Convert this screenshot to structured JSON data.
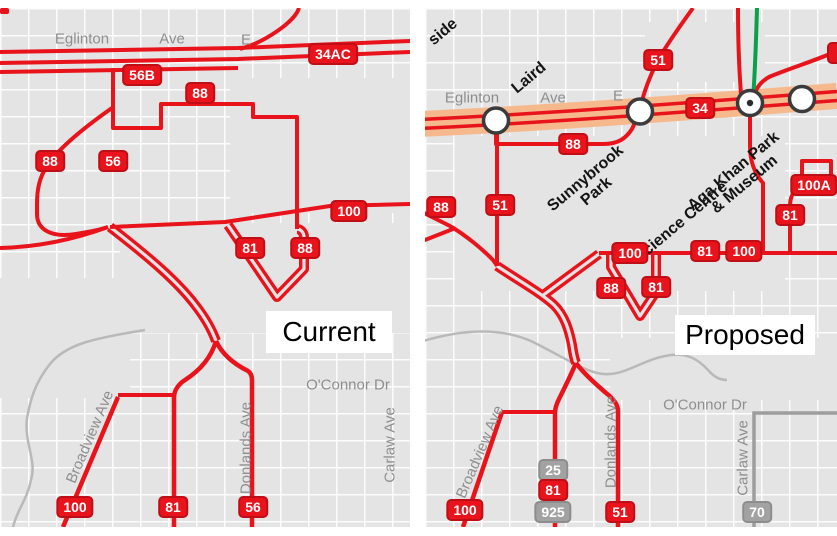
{
  "colors": {
    "route_red": "#e8131b",
    "lrt_orange": "#f6b98e",
    "subway_green": "#0aa04c",
    "other_route_gray": "#9d9d9d",
    "badge_gray": "#a2a2a2",
    "map_background": "#e4e4e4"
  },
  "panels": [
    {
      "id": "current",
      "title": "Current",
      "badges": [
        {
          "t": "34AC",
          "x": 333,
          "y": 46
        },
        {
          "t": "56B",
          "x": 142,
          "y": 67
        },
        {
          "t": "88",
          "x": 200,
          "y": 85
        },
        {
          "t": "88",
          "x": 50,
          "y": 153
        },
        {
          "t": "56",
          "x": 113,
          "y": 153
        },
        {
          "t": "100",
          "x": 349,
          "y": 203
        },
        {
          "t": "81",
          "x": 250,
          "y": 240
        },
        {
          "t": "88",
          "x": 305,
          "y": 240
        },
        {
          "t": "100",
          "x": 75,
          "y": 499
        },
        {
          "t": "81",
          "x": 173,
          "y": 499
        },
        {
          "t": "56",
          "x": 253,
          "y": 499
        }
      ],
      "street_labels": [
        {
          "t": "Eglinton",
          "x": 82,
          "y": 31,
          "rot": 0
        },
        {
          "t": "Ave",
          "x": 172,
          "y": 31,
          "rot": 0
        },
        {
          "t": "E",
          "x": 246,
          "y": 32,
          "rot": 0
        },
        {
          "t": "O'Connor Dr",
          "x": 348,
          "y": 377,
          "rot": 0
        },
        {
          "t": "Broadview Ave",
          "x": 90,
          "y": 429,
          "rot": -67
        },
        {
          "t": "Donlands Ave",
          "x": 246,
          "y": 440,
          "rot": -90
        },
        {
          "t": "Carlaw Ave",
          "x": 390,
          "y": 437,
          "rot": -90
        }
      ],
      "station_labels": []
    },
    {
      "id": "proposed",
      "title": "Proposed",
      "badges": [
        {
          "t": "51",
          "x": 233,
          "y": 52
        },
        {
          "t": "",
          "x": 420,
          "y": 45,
          "style": "cut"
        },
        {
          "t": "34",
          "x": 275,
          "y": 100
        },
        {
          "t": "88",
          "x": 148,
          "y": 136
        },
        {
          "t": "88",
          "x": 16,
          "y": 199
        },
        {
          "t": "51",
          "x": 75,
          "y": 197
        },
        {
          "t": "100",
          "x": 205,
          "y": 245
        },
        {
          "t": "81",
          "x": 280,
          "y": 243
        },
        {
          "t": "100",
          "x": 319,
          "y": 243
        },
        {
          "t": "81",
          "x": 365,
          "y": 207
        },
        {
          "t": "100A",
          "x": 389,
          "y": 177
        },
        {
          "t": "88",
          "x": 186,
          "y": 280
        },
        {
          "t": "81",
          "x": 231,
          "y": 279
        },
        {
          "t": "100",
          "x": 40,
          "y": 502
        },
        {
          "t": "25",
          "x": 128,
          "y": 462,
          "style": "gray"
        },
        {
          "t": "81",
          "x": 128,
          "y": 482
        },
        {
          "t": "925",
          "x": 128,
          "y": 504,
          "style": "gray"
        },
        {
          "t": "51",
          "x": 195,
          "y": 504
        },
        {
          "t": "70",
          "x": 332,
          "y": 504,
          "style": "gray"
        }
      ],
      "street_labels": [
        {
          "t": "Eglinton",
          "x": 47,
          "y": 90,
          "rot": 0
        },
        {
          "t": "Ave",
          "x": 128,
          "y": 90,
          "rot": 0
        },
        {
          "t": "E",
          "x": 193,
          "y": 88,
          "rot": 0
        },
        {
          "t": "O'Connor Dr",
          "x": 280,
          "y": 397,
          "rot": 0
        },
        {
          "t": "Broadview Ave",
          "x": 55,
          "y": 444,
          "rot": -67
        },
        {
          "t": "Donlands Ave",
          "x": 186,
          "y": 434,
          "rot": -90
        },
        {
          "t": "Carlaw Ave",
          "x": 318,
          "y": 450,
          "rot": -90
        }
      ],
      "station_labels": [
        {
          "lines": [
            "side"
          ],
          "x": 18,
          "y": 24,
          "rot": -40
        },
        {
          "lines": [
            "Laird"
          ],
          "x": 104,
          "y": 70,
          "rot": -40
        },
        {
          "lines": [
            "Sunnybrook",
            "Park"
          ],
          "x": 166,
          "y": 177,
          "rot": -40
        },
        {
          "lines": [
            "Science Centre"
          ],
          "x": 256,
          "y": 214,
          "rot": -40
        },
        {
          "lines": [
            "Aga Khan Park",
            "& Museum"
          ],
          "x": 314,
          "y": 170,
          "rot": -40
        }
      ]
    }
  ]
}
